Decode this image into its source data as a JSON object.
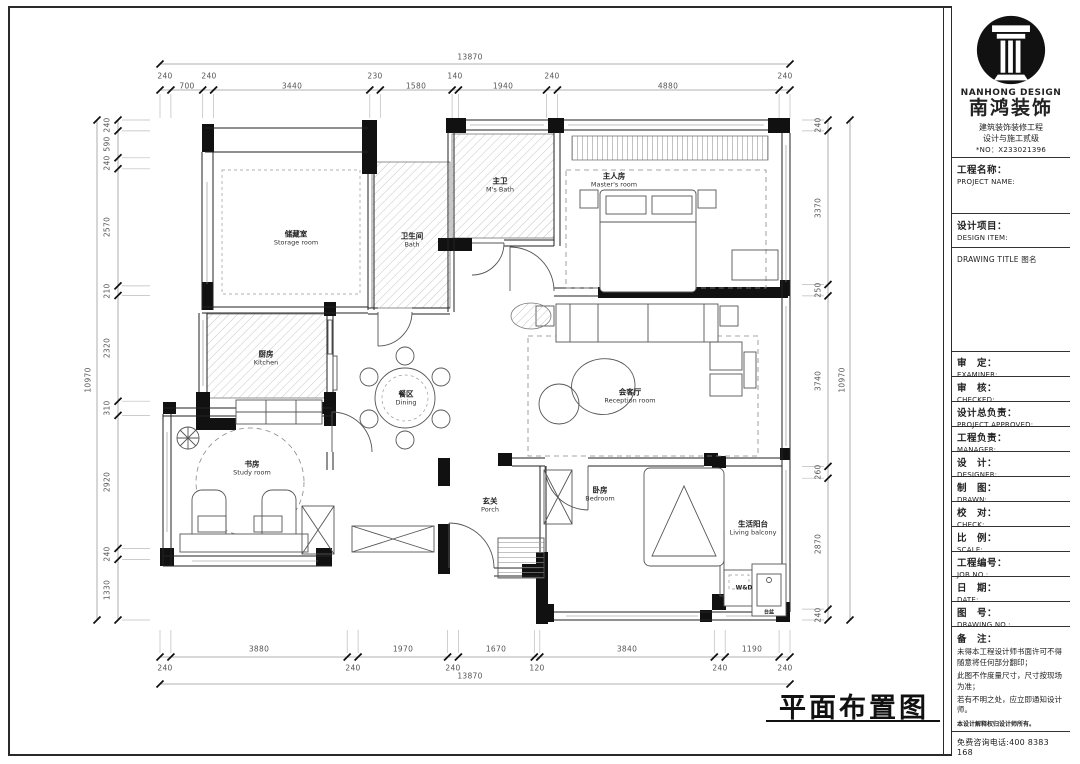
{
  "sheet": {
    "drawing_title": "平面布置图"
  },
  "title_block": {
    "company_en": "NANHONG DESIGN",
    "company_cn": "南鸿装饰",
    "cert_line1": "建筑装饰装修工程",
    "cert_line2": "设计与施工贰级",
    "license_no": "*NO：X233021396",
    "project_name": {
      "cn": "工程名称：",
      "en": "PROJECT NAME:"
    },
    "design_item": {
      "cn": "设计项目：",
      "en": "DESIGN ITEM:"
    },
    "drawing_title_label": "DRAWING TITLE 图名",
    "rows": [
      {
        "cn": "审　定：",
        "en": "EXAMINER:"
      },
      {
        "cn": "审　核：",
        "en": "CHECKED:"
      },
      {
        "cn": "设计总负责：",
        "en": "PROJECT APPROVED:"
      },
      {
        "cn": "工程负责：",
        "en": "MANAGER:"
      },
      {
        "cn": "设　计：",
        "en": "DESIGNER:"
      },
      {
        "cn": "制　图：",
        "en": "DRAWN:"
      },
      {
        "cn": "校　对：",
        "en": "CHECK:"
      },
      {
        "cn": "比　例：",
        "en": "SCALE:"
      },
      {
        "cn": "工程编号：",
        "en": "JOB NO.:"
      },
      {
        "cn": "日　期：",
        "en": "DATE:"
      },
      {
        "cn": "图　号：",
        "en": "DRAWING NO.:"
      }
    ],
    "notes_title": "备　注：",
    "notes": [
      "未得本工程设计师书面许可不得随意将任何部分翻印；",
      "此图不作度量尺寸，尺寸按现场为准；",
      "若有不明之处，应立即通知设计师。"
    ],
    "disclaimer": "本设计解释权归设计师所有。",
    "hotline": "免费咨询电话:400 8383 168"
  },
  "dims": {
    "top_total": "13870",
    "top": [
      "240",
      "700",
      "240",
      "3440",
      "230",
      "1580",
      "140",
      "1940",
      "240",
      "4880",
      "240"
    ],
    "bottom_total": "13870",
    "bottom": [
      "240",
      "3880",
      "240",
      "1970",
      "240",
      "1670",
      "120",
      "3840",
      "240",
      "1190",
      "240"
    ],
    "left_total": "10970",
    "left": [
      "240",
      "590",
      "240",
      "2570",
      "210",
      "2320",
      "310",
      "2920",
      "240",
      "1330"
    ],
    "right_total": "10970",
    "right": [
      "240",
      "3370",
      "250",
      "3740",
      "260",
      "2870",
      "240"
    ]
  },
  "rooms": [
    {
      "cn": "储藏室",
      "en": "Storage room"
    },
    {
      "cn": "卫生间",
      "en": "Bath"
    },
    {
      "cn": "主卫",
      "en": "M's Bath"
    },
    {
      "cn": "主人房",
      "en": "Master's room"
    },
    {
      "cn": "厨房",
      "en": "Kitchen"
    },
    {
      "cn": "餐区",
      "en": "Dining"
    },
    {
      "cn": "会客厅",
      "en": "Reception room"
    },
    {
      "cn": "书房",
      "en": "Study room"
    },
    {
      "cn": "玄关",
      "en": "Porch"
    },
    {
      "cn": "卧房",
      "en": "Bedroom"
    },
    {
      "cn": "生活阳台",
      "en": "Living balcony"
    }
  ],
  "annotations": {
    "washer_dryer": "W&D",
    "basin": "台盆"
  },
  "colors": {
    "wall": "#111111",
    "hatch_line": "#aaaaaa",
    "dim_text": "#555555"
  }
}
